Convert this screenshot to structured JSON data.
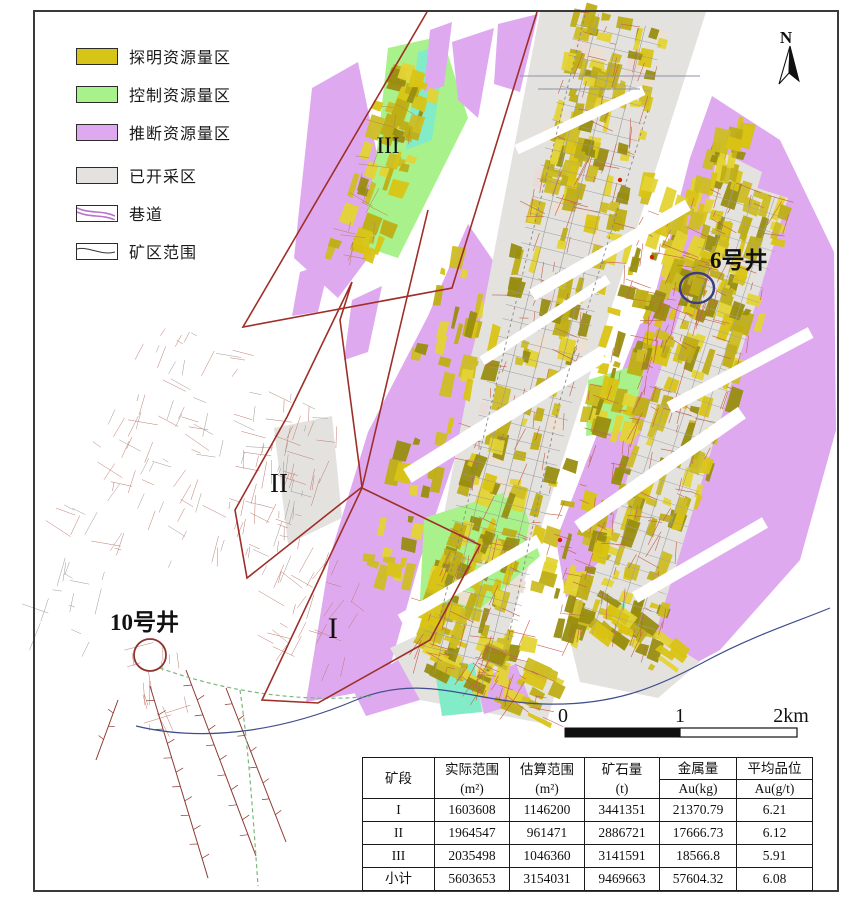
{
  "legend": {
    "items": [
      {
        "label": "探明资源量区",
        "type": "fill",
        "color": "#d6c516"
      },
      {
        "label": "控制资源量区",
        "type": "fill",
        "color": "#a8f18b"
      },
      {
        "label": "推断资源量区",
        "type": "fill",
        "color": "#dfa9ef"
      },
      {
        "label": "已开采区",
        "type": "fill",
        "color": "#e4e2df"
      },
      {
        "label": "巷道",
        "type": "tunnel-line",
        "color": "#b873cc"
      },
      {
        "label": "矿区范围",
        "type": "boundary-line",
        "color": "#333333"
      }
    ]
  },
  "north_arrow": {
    "label": "N"
  },
  "map": {
    "zone_labels": [
      {
        "text": "III"
      },
      {
        "text": "II"
      },
      {
        "text": "I"
      }
    ],
    "well_labels": [
      {
        "text": "6号井"
      },
      {
        "text": "10号井"
      }
    ]
  },
  "scale_bar": {
    "ticks": [
      "0",
      "1",
      "2km"
    ]
  },
  "table": {
    "headers": [
      {
        "l1": "矿段",
        "l2": ""
      },
      {
        "l1": "实际范围",
        "l2": "(m²)"
      },
      {
        "l1": "估算范围",
        "l2": "(m²)"
      },
      {
        "l1": "矿石量",
        "l2": "(t)"
      },
      {
        "l1": "金属量",
        "l2": "Au(kg)"
      },
      {
        "l1": "平均品位",
        "l2": "Au(g/t)"
      }
    ],
    "rows": [
      {
        "cells": [
          "I",
          "1603608",
          "1146200",
          "3441351",
          "21370.79",
          "6.21"
        ]
      },
      {
        "cells": [
          "II",
          "1964547",
          "961471",
          "2886721",
          "17666.73",
          "6.12"
        ]
      },
      {
        "cells": [
          "III",
          "2035498",
          "1046360",
          "3141591",
          "18566.8",
          "5.91"
        ]
      },
      {
        "cells": [
          "小计",
          "5603653",
          "3154031",
          "9469663",
          "57604.32",
          "6.08"
        ]
      }
    ]
  },
  "palette": {
    "proved": "#d6c516",
    "controlled": "#a8f18b",
    "inferred": "#dfa9ef",
    "mined": "#e4e2df",
    "tunnel_red": "#c4604e",
    "boundary_red": "#9e2f28",
    "boundary_blue": "#3f4e8c"
  }
}
